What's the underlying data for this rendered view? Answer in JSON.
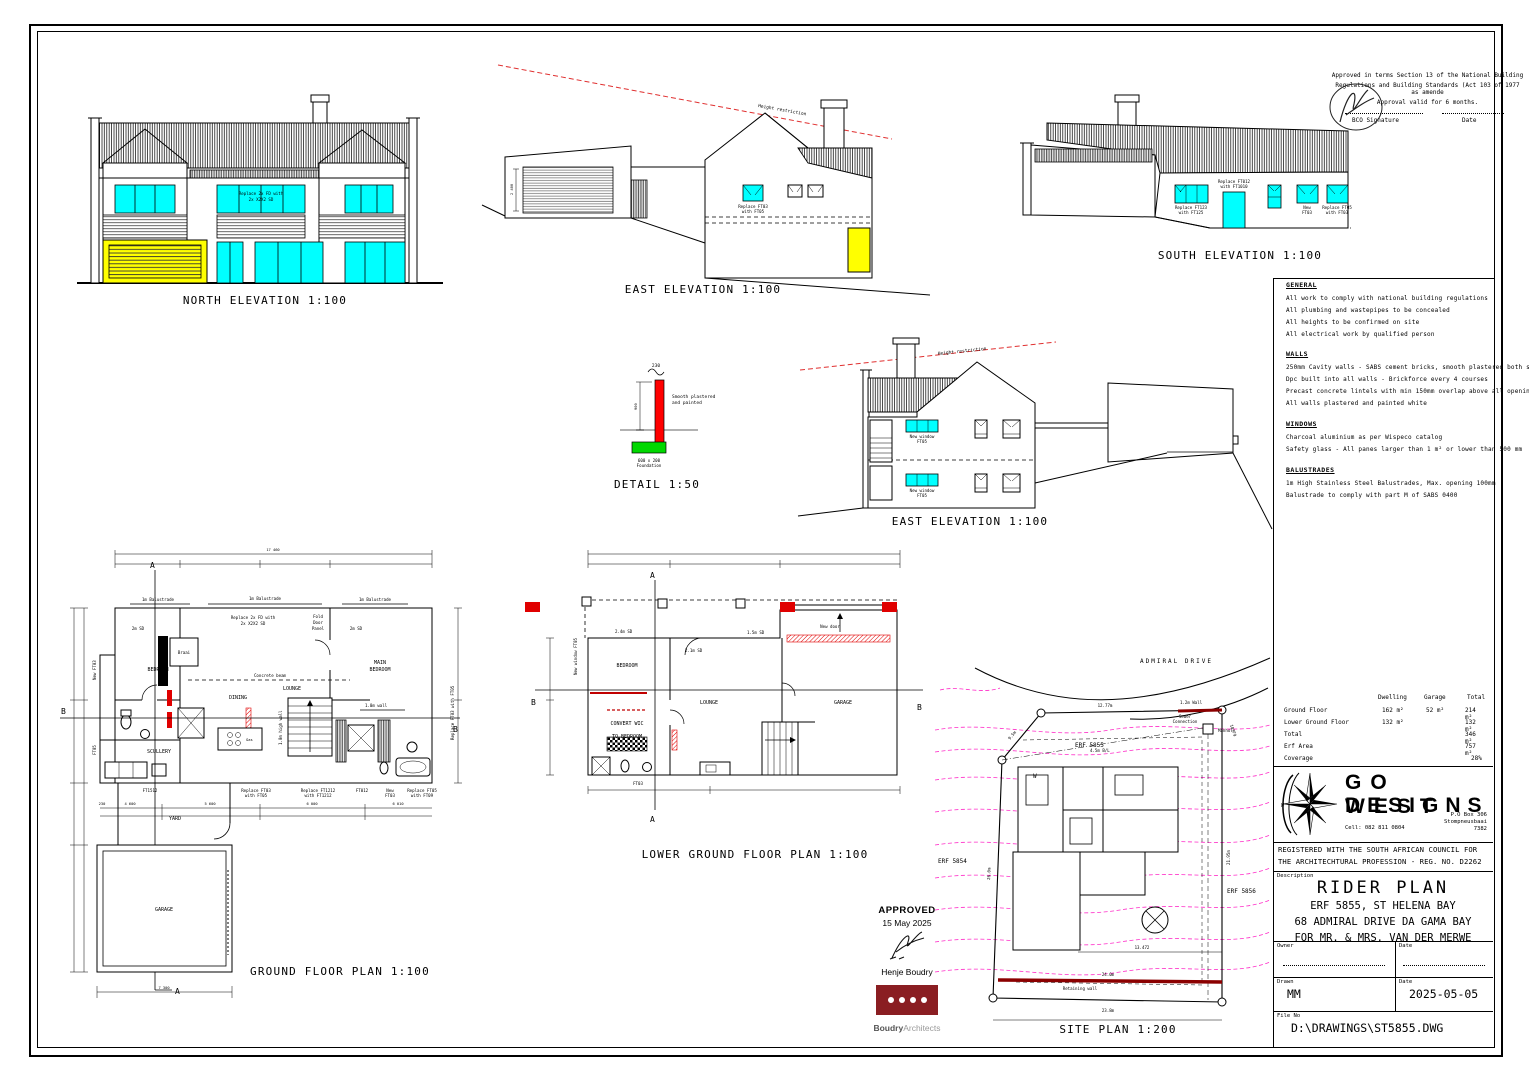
{
  "colors": {
    "window_cyan": "#00ffff",
    "door_yellow": "#ffff00",
    "new_wall_red": "#e00000",
    "foundation_green": "#00d800",
    "contour_magenta": "#ff2cc8",
    "stamp_dark_red": "#8a1e22",
    "restriction_red": "#e03030",
    "retaining_dark_red": "#8b0000"
  },
  "titles": {
    "north": "NORTH ELEVATION 1:100",
    "east1": "EAST ELEVATION 1:100",
    "south": "SOUTH ELEVATION 1:100",
    "east2": "EAST ELEVATION 1:100",
    "detail": "DETAIL 1:50",
    "ground": "GROUND FLOOR PLAN 1:100",
    "lower": "LOWER GROUND FLOOR PLAN 1:100",
    "site": "SITE PLAN 1:200"
  },
  "approval": {
    "l1": "Approved in terms Section 13 of the National Building",
    "l2": "Regulations and Building Standards (Act 103 of 1977 as amende",
    "l3": "Approval valid for 6 months.",
    "sig_label": "BCO Signature",
    "date_label": "Date"
  },
  "north_lbl": {
    "win1": "Replace 2x FD with",
    "win2": "2x X2X2 SD"
  },
  "east1_lbl": {
    "restriction": "Height restriction",
    "dim": "2 400",
    "win1": "Replace FT03",
    "win2": "with FT05"
  },
  "south_lbl": {
    "w1a": "Replace FT123",
    "w1b": "with FT125",
    "d1a": "Replace FT012",
    "d1b": "with FT1010",
    "w2a": "New",
    "w2b": "FT03",
    "w3a": "Replace FT05",
    "w3b": "with FT03"
  },
  "east2_lbl": {
    "restriction": "Height restriction",
    "wina": "New window",
    "winb": "FT05"
  },
  "detail_lbl": {
    "dim_top": "230",
    "dim_side": "900",
    "n1": "Smooth plastered",
    "n2": "and painted",
    "f1": "600 x 200",
    "f2": "Foundation"
  },
  "notes": {
    "general_h": "GENERAL",
    "general": [
      "All work to comply with national building regulations",
      "All plumbing and wastepipes to be concealed",
      "All heights to be confirmed on site",
      "All electrical work by qualified person"
    ],
    "walls_h": "WALLS",
    "walls": [
      "250mm Cavity walls - SABS cement bricks, smooth plastered both sides",
      "Dpc built into all walls - Brickforce every 4 courses",
      "Precast concrete lintels with min 150mm overlap above all openings",
      "All walls plastered and painted white"
    ],
    "windows_h": "WINDOWS",
    "windows": [
      "Charcoal aluminium as per Wispeco catalog",
      "Safety glass -  All panes larger than 1 m² or lower than 500 mm"
    ],
    "bal_h": "BALUSTRADES",
    "bal": [
      "1m High Stainless Steel Balustrades, Max. opening 100mm",
      "Balustrade to comply with part M of SABS 0400"
    ]
  },
  "areas": {
    "c1": "Dwelling",
    "c2": "Garage",
    "c3": "Total",
    "rows": [
      {
        "l": "Ground Floor",
        "d": "162 m²",
        "g": "52 m²",
        "t": "214 m²"
      },
      {
        "l": "Lower Ground Floor",
        "d": "132 m²",
        "g": "",
        "t": "132 m²"
      },
      {
        "l": "Total",
        "d": "",
        "g": "",
        "t": "346 m²"
      },
      {
        "l": "Erf Area",
        "d": "",
        "g": "",
        "t": "757 m²"
      },
      {
        "l": "Coverage",
        "d": "",
        "g": "",
        "t": "28%"
      }
    ]
  },
  "tb": {
    "go": "GO WEST",
    "designs": "DESIGNS",
    "cell": "Cell: 082 811 0804",
    "po1": "P.O Box 306",
    "po2": "Stompneusbaai",
    "po3": "7382",
    "reg1": "REGISTERED WITH THE SOUTH AFRICAN COUNCIL FOR",
    "reg2": "THE ARCHITECHTURAL PROFESSION - REG. NO. D2262",
    "desc_l": "Description",
    "t1": "RIDER PLAN",
    "t2": "ERF 5855, ST HELENA BAY",
    "t3": "68 ADMIRAL DRIVE DA  GAMA BAY",
    "t4": "FOR MR. & MRS. VAN DER MERWE",
    "owner_l": "Owner",
    "date_l": "Date",
    "drawn_l": "Drawn",
    "drawn": "MM",
    "date": "2025-05-05",
    "file_l": "File No",
    "file": "D:\\DRAWINGS\\ST5855.DWG"
  },
  "stamp": {
    "approved": "APPROVED",
    "date": "15 May 2025",
    "name": "Henje Boudry",
    "brand_b": "Boudry",
    "brand_l": "Architects"
  },
  "gp": {
    "rooms": {
      "bedroom": "BEDROOM",
      "dining": "DINING",
      "lounge": "LOUNGE",
      "main1": "MAIN",
      "main2": "BEDROOM",
      "scullery": "SCULLERY",
      "yard": "YARD",
      "garage": "GARAGE"
    },
    "lbl": {
      "bal": "1m Balustrade",
      "braai": "Braai",
      "beam": "Concrete beam",
      "fd1": "Replace 2x FD with",
      "fd2": "2x X2X2 SD",
      "fold1": "Fold",
      "fold2": "Door",
      "fold3": "Panel",
      "sd2": "2m SD",
      "wall1": "1.0m wall",
      "wall2": "1.0m high wall",
      "gas": "Gas",
      "a": "A",
      "b": "B",
      "newft03": "New FT03",
      "ft05": "FT05",
      "ft1512": "FT1512",
      "w1a": "Replace FT03",
      "w1b": "with FT05",
      "w2a": "Replace FT1212",
      "w2b": "with FT1212",
      "w3": "FT012",
      "w4a": "New",
      "w4b": "FT03",
      "w5a": "Replace FT05",
      "w5b": "with FT09",
      "wr": "Replace FT03 with FT05",
      "dim_top": "17 460",
      "d1": "4 600",
      "d2": "5 600",
      "d3": "6 000",
      "d4": "6 010",
      "d5": "230",
      "d6": "7 300"
    }
  },
  "lp": {
    "rooms": {
      "bedroom": "BEDROOM",
      "wic1": "CONVERT WIC",
      "wic2": "TO BEDROOM",
      "lounge": "LOUNGE",
      "garage": "GARAGE"
    },
    "lbl": {
      "newdoor": "New door",
      "sd24": "2.4m SD",
      "sd21": "2.1m SD",
      "sd15": "1.5m SD",
      "nw": "New window FT05",
      "ft03": "FT03",
      "a": "A",
      "b": "B"
    }
  },
  "sp": {
    "road": "ADMIRAL DRIVE",
    "erf": "ERF 5855",
    "erf_l": "ERF 5854",
    "erf_r": "ERF 5856",
    "sewer1": "Sewer",
    "sewer2": "Connection",
    "manhole": "Manhole",
    "wall": "1.2m Wall",
    "d1": "12.77m",
    "bl": "4.5m B/L",
    "d2": "10.79",
    "d3": "9.5m",
    "d4": "26.0m",
    "d5": "21.95m",
    "ret": "Retaining wall",
    "d6": "24.0m",
    "d7": "23.8m",
    "d8": "13.472",
    "w": "W"
  }
}
